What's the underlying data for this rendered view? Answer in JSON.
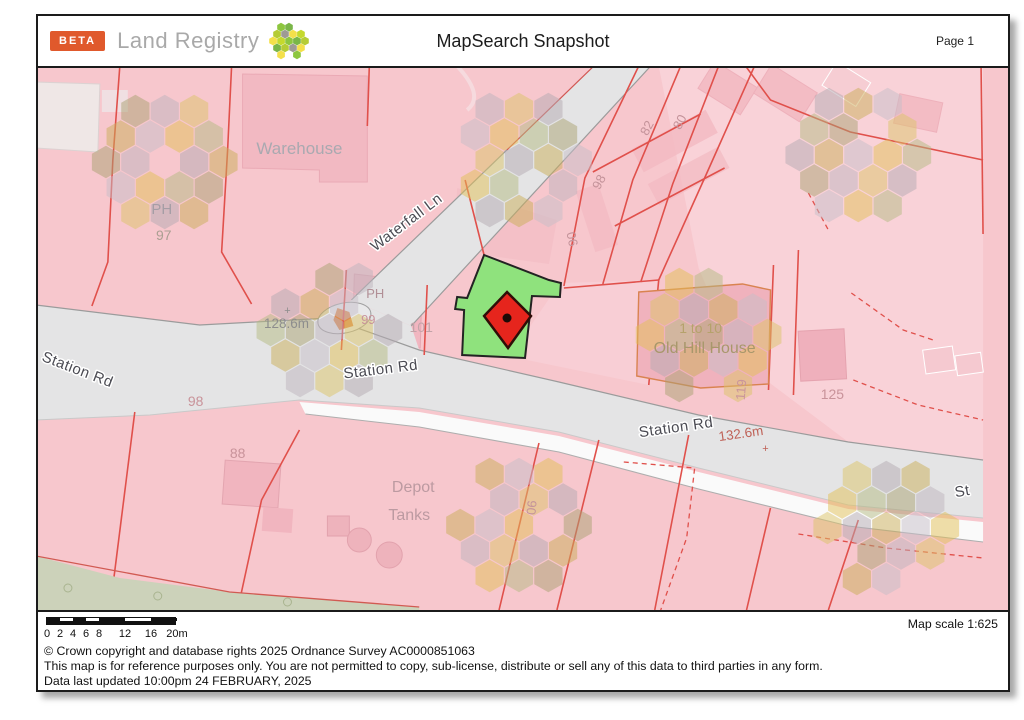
{
  "header": {
    "beta": "BETA",
    "brand": "Land Registry",
    "title": "MapSearch Snapshot",
    "page": "Page 1"
  },
  "footer": {
    "map_scale": "Map scale 1:625",
    "copyright": "© Crown copyright and database rights 2025 Ordnance Survey AC0000851063",
    "disclaimer": "This map is for reference purposes only. You are not permitted to copy, sub-license, distribute or sell any of this data to third parties in any form.",
    "updated": "Data last updated 10:00pm 24 FEBRUARY, 2025",
    "scale_values": [
      0,
      2,
      4,
      6,
      8,
      12,
      16,
      20
    ],
    "scale_labels": [
      "0",
      "2",
      "4",
      "6",
      "8",
      "12",
      "16",
      "20m"
    ]
  },
  "map": {
    "colors": {
      "background_pink": "#f7c7cd",
      "boundary_red": "#e0504b",
      "selected_green": "#8fe27d",
      "marker_red": "#e6251d",
      "road_gray": "#e4e4e5",
      "beta_orange": "#e0592c"
    },
    "hex_palette": [
      "#e2bf55",
      "#b3a9b2",
      "#a9a271",
      "#c6bdc7",
      "#dcc468",
      "#b4ba82",
      "#c9ae58",
      "#bdb4bd"
    ],
    "hex_clusters": [
      {
        "cx": 127,
        "cy": 94,
        "seed": 1
      },
      {
        "cx": 482,
        "cy": 92,
        "seed": 4
      },
      {
        "cx": 822,
        "cy": 87,
        "seed": 2
      },
      {
        "cx": 292,
        "cy": 262,
        "seed": 6
      },
      {
        "cx": 672,
        "cy": 267,
        "seed": 3
      },
      {
        "cx": 482,
        "cy": 457,
        "seed": 5
      },
      {
        "cx": 850,
        "cy": 460,
        "seed": 7
      }
    ],
    "labels": [
      {
        "text": "Warehouse",
        "x": 262,
        "y": 86,
        "size": 17,
        "color": "#a9a9b0",
        "rot": 0,
        "halo": false
      },
      {
        "text": "PH",
        "x": 124,
        "y": 146,
        "size": 15,
        "color": "#a59da5",
        "rot": 0,
        "halo": false
      },
      {
        "text": "97",
        "x": 126,
        "y": 172,
        "size": 14,
        "color": "#ab9f92",
        "rot": 0,
        "halo": false
      },
      {
        "text": "Waterfall Ln",
        "x": 372,
        "y": 158,
        "size": 15,
        "color": "#4b4b53",
        "rot": -37,
        "halo": true
      },
      {
        "text": "06",
        "x": 531,
        "y": 172,
        "size": 13,
        "color": "#c4939a",
        "rot": 78,
        "halo": false
      },
      {
        "text": "98",
        "x": 566,
        "y": 116,
        "size": 13,
        "color": "#c4939a",
        "rot": -62,
        "halo": false
      },
      {
        "text": "82",
        "x": 614,
        "y": 62,
        "size": 13,
        "color": "#c4939a",
        "rot": -62,
        "halo": false
      },
      {
        "text": "80",
        "x": 647,
        "y": 56,
        "size": 13,
        "color": "#c4939a",
        "rot": -62,
        "halo": false
      },
      {
        "text": "PH",
        "x": 338,
        "y": 230,
        "size": 13,
        "color": "#b18f96",
        "rot": 0,
        "halo": false
      },
      {
        "text": "99",
        "x": 331,
        "y": 256,
        "size": 13,
        "color": "#c9949b",
        "rot": 0,
        "halo": false
      },
      {
        "text": "101",
        "x": 384,
        "y": 264,
        "size": 14,
        "color": "#c2a3a8",
        "rot": 0,
        "halo": false
      },
      {
        "text": "128.6m",
        "x": 249,
        "y": 260,
        "size": 13.5,
        "color": "#8d8d8d",
        "rot": 0,
        "halo": false
      },
      {
        "text": "+",
        "x": 250,
        "y": 246,
        "size": 11,
        "color": "#8d8d8d",
        "rot": 0,
        "halo": false
      },
      {
        "text": "Station Rd",
        "x": 38,
        "y": 306,
        "size": 15,
        "color": "#4b4b53",
        "rot": 21,
        "halo": true
      },
      {
        "text": "Station Rd",
        "x": 344,
        "y": 306,
        "size": 15,
        "color": "#4b4b53",
        "rot": -7,
        "halo": true
      },
      {
        "text": "Station Rd",
        "x": 640,
        "y": 364,
        "size": 15,
        "color": "#4b4b53",
        "rot": -8,
        "halo": true
      },
      {
        "text": "132.6m",
        "x": 705,
        "y": 370,
        "size": 13.5,
        "color": "#bf6157",
        "rot": -8,
        "halo": false
      },
      {
        "text": "+",
        "x": 729,
        "y": 384,
        "size": 11,
        "color": "#bf6157",
        "rot": 0,
        "halo": false
      },
      {
        "text": "1 to 10",
        "x": 664,
        "y": 265,
        "size": 14,
        "color": "#b5a26b",
        "rot": 0,
        "halo": false
      },
      {
        "text": "Old Hill House",
        "x": 668,
        "y": 285,
        "size": 16,
        "color": "#a8976b",
        "rot": 0,
        "halo": false
      },
      {
        "text": "119",
        "x": 709,
        "y": 322,
        "size": 13,
        "color": "#c9949b",
        "rot": -85,
        "halo": false
      },
      {
        "text": "125",
        "x": 796,
        "y": 331,
        "size": 14,
        "color": "#c9939a",
        "rot": 0,
        "halo": false
      },
      {
        "text": "98",
        "x": 158,
        "y": 338,
        "size": 14,
        "color": "#c9939a",
        "rot": 0,
        "halo": false
      },
      {
        "text": "88",
        "x": 200,
        "y": 390,
        "size": 14,
        "color": "#c9939a",
        "rot": 0,
        "halo": false
      },
      {
        "text": "Depot",
        "x": 376,
        "y": 424,
        "size": 16,
        "color": "#bc9aa1",
        "rot": 0,
        "halo": false
      },
      {
        "text": "Tanks",
        "x": 372,
        "y": 452,
        "size": 16,
        "color": "#bc9aa1",
        "rot": 0,
        "halo": false
      },
      {
        "text": "06",
        "x": 499,
        "y": 440,
        "size": 13,
        "color": "#c4939a",
        "rot": -85,
        "halo": false
      },
      {
        "text": "St",
        "x": 927,
        "y": 428,
        "size": 15,
        "color": "#4b4b53",
        "rot": -10,
        "halo": true
      }
    ]
  },
  "logo": {
    "palette": [
      "#8dc63f",
      "#c5d92d",
      "#f4e04b",
      "#9e9b94",
      "#b5cc35",
      "#7ab648"
    ]
  }
}
